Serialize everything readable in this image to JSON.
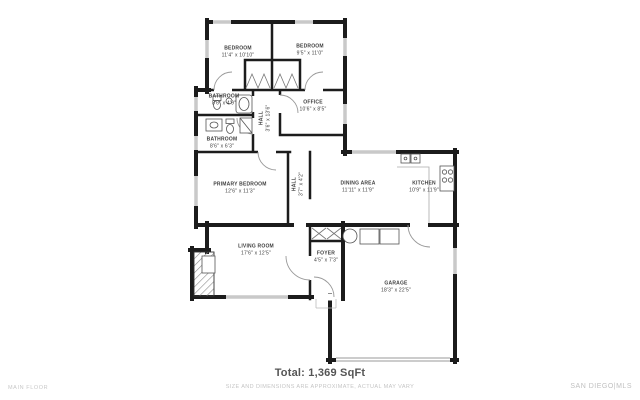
{
  "footer": {
    "total": "Total: 1,369 SqFt",
    "disclaimer": "SIZE AND DIMENSIONS ARE APPROXIMATE, ACTUAL MAY VARY",
    "floor_label": "MAIN FLOOR",
    "brand": "SAN DIEGO|MLS"
  },
  "rooms": [
    {
      "name": "BEDROOM",
      "dims": "11'4\" x 10'10\""
    },
    {
      "name": "BEDROOM",
      "dims": "9'5\" x 11'0\""
    },
    {
      "name": "BATHROOM",
      "dims": "8'6\" x 4'9\""
    },
    {
      "name": "HALL",
      "dims": "3'6\" x 13'6\""
    },
    {
      "name": "OFFICE",
      "dims": "10'6\" x 8'5\""
    },
    {
      "name": "BATHROOM",
      "dims": "8'6\" x 6'3\""
    },
    {
      "name": "PRIMARY BEDROOM",
      "dims": "12'6\" x 11'3\""
    },
    {
      "name": "HALL",
      "dims": "3'7\" x 4'2\""
    },
    {
      "name": "DINING AREA",
      "dims": "11'11\" x 11'9\""
    },
    {
      "name": "KITCHEN",
      "dims": "10'9\" x 11'9\""
    },
    {
      "name": "LIVING ROOM",
      "dims": "17'6\" x 12'5\""
    },
    {
      "name": "FOYER",
      "dims": "4'5\" x 7'3\""
    },
    {
      "name": "GARAGE",
      "dims": "18'3\" x 22'5\""
    }
  ],
  "plan": {
    "fixtures": [
      "fireplace",
      "bathtub",
      "toilet",
      "sink",
      "shower",
      "vanity",
      "kitchen-sink",
      "stove",
      "water-heater",
      "washer-dryer",
      "garage-door",
      "closet-bifold-doors",
      "window",
      "door-swing"
    ]
  },
  "colors": {
    "wall": "#1c1c1c",
    "window": "#c9c9c9",
    "door_arc": "#999999",
    "room_text": "#3d3d3d",
    "muted_text": "#c5c5c5",
    "total_text": "#555555"
  }
}
